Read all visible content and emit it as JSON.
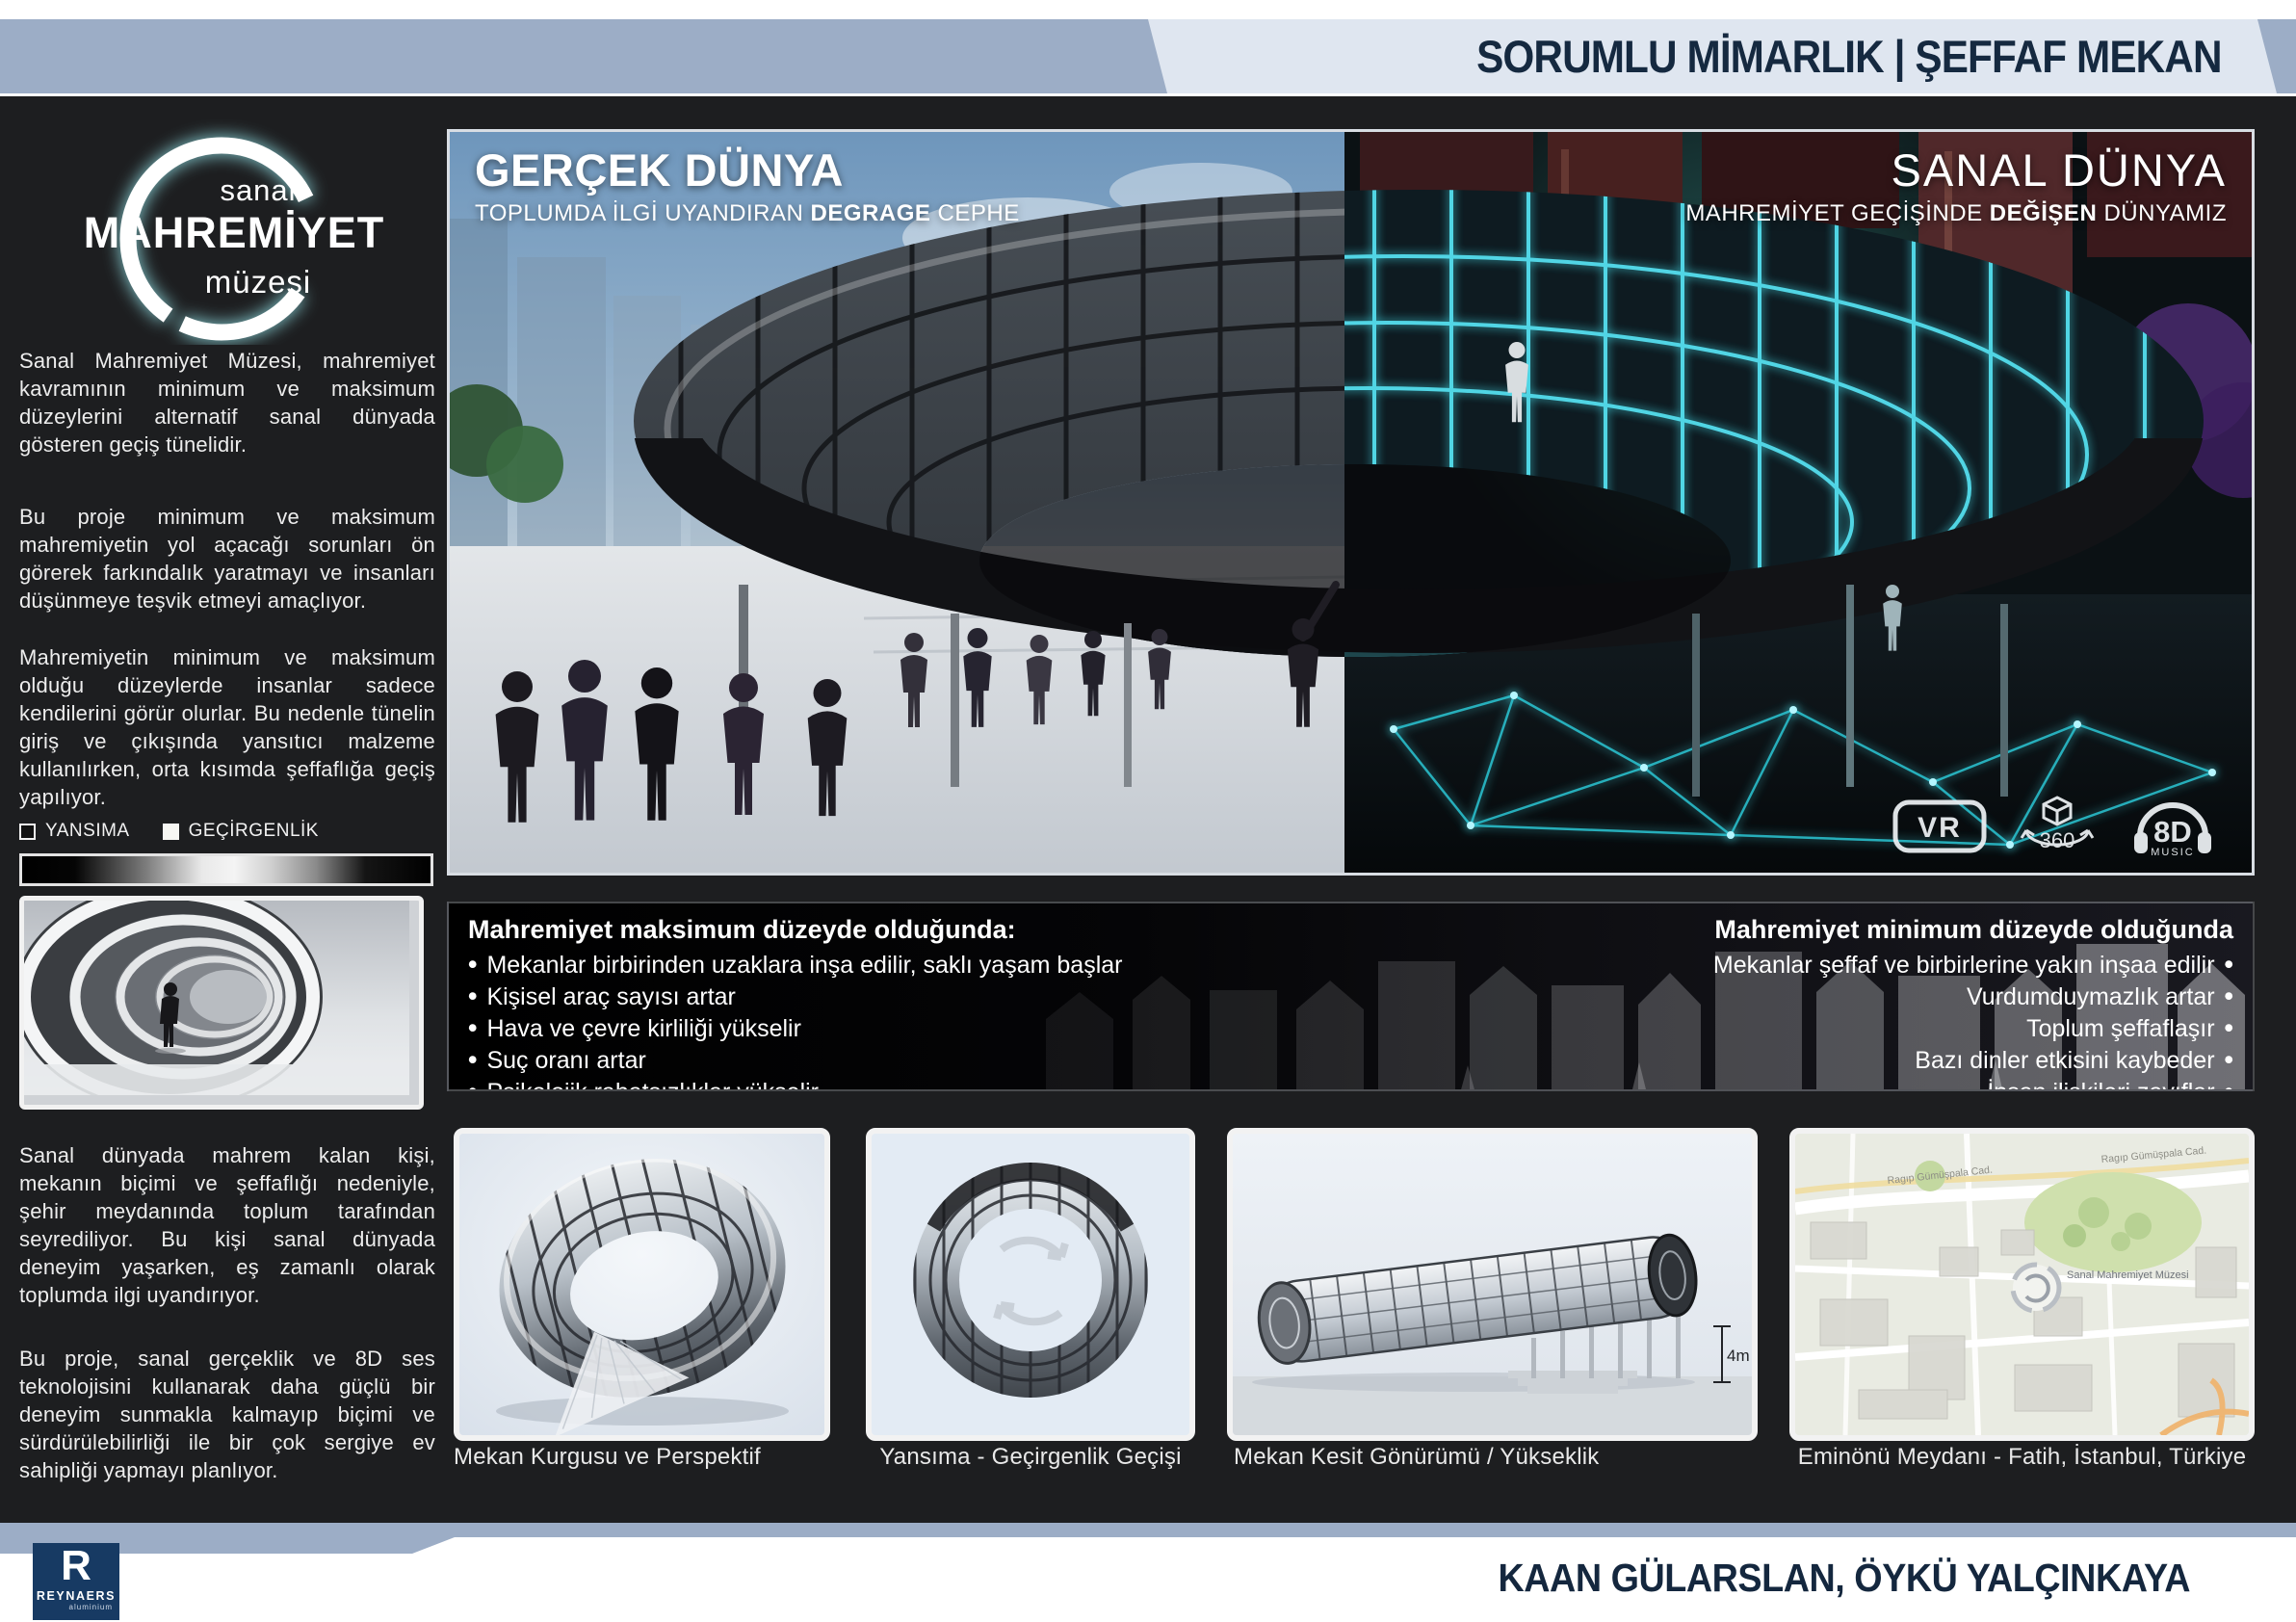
{
  "header": {
    "title": "SORUMLU MİMARLIK | ŞEFFAF MEKAN"
  },
  "logo": {
    "line1": "sanal",
    "line2": "MAHREMİYET",
    "line3": "müzesi"
  },
  "sidebar": {
    "paragraphs": [
      "Sanal Mahremiyet Müzesi, mahremiyet kavramının minimum ve maksimum düzeylerini alternatif sanal dünyada gösteren geçiş tünelidir.",
      "Bu proje minimum ve maksimum mahremiyetin yol açacağı sorunları ön görerek farkındalık yaratmayı ve insanları düşünmeye teşvik etmeyi amaçlıyor.",
      "Mahremiyetin minimum ve maksimum olduğu düzeylerde insanlar sadece kendilerini görür olurlar. Bu nedenle tünelin giriş ve çıkışında yansıtıcı malzeme kullanılırken, orta kısımda şeffaflığa geçiş yapılıyor.",
      "Sanal dünyada mahrem kalan kişi, mekanın biçimi ve şeffaflığı nedeniyle, şehir meydanında toplum tarafından seyrediliyor. Bu kişi sanal dünyada deneyim yaşarken, eş zamanlı olarak toplumda ilgi uyandırıyor.",
      "Bu proje, sanal gerçeklik ve 8D ses teknolojisini kullanarak daha güçlü bir deneyim sunmakla kalmayıp biçimi ve sürdürülebilirliği ile bir çok sergiye ev sahipliği yapmayı planlıyor."
    ],
    "legend": {
      "item1": "YANSIMA",
      "item2": "GEÇİRGENLİK"
    }
  },
  "hero": {
    "left": {
      "title": "GERÇEK DÜNYA",
      "sub_pre": "TOPLUMDA İLGİ UYANDIRAN ",
      "sub_bold": "DEGRAGE",
      "sub_post": " CEPHE"
    },
    "right": {
      "title": "SANAL DÜNYA",
      "sub_pre": "MAHREMİYET GEÇİŞİNDE ",
      "sub_bold": "DEĞİŞEN",
      "sub_post": " DÜNYAMIZ"
    },
    "badges": {
      "vr": "VR",
      "deg360": "360",
      "eightd": "8D",
      "eightd_sub": "MUSIC"
    }
  },
  "conditions": {
    "max": {
      "title": "Mahremiyet maksimum düzeyde olduğunda:",
      "items": [
        "Mekanlar birbirinden uzaklara inşa edilir, saklı yaşam başlar",
        "Kişisel araç sayısı artar",
        "Hava ve çevre kirliliği yükselir",
        "Suç oranı artar",
        "Psikolojik rahatsızlıklar yükselir"
      ]
    },
    "min": {
      "title": "Mahremiyet minimum düzeyde olduğunda",
      "items": [
        "Mekanlar şeffaf ve birbirlerine yakın inşaa edilir",
        "Vurdumduymazlık artar",
        "Toplum şeffaflaşır",
        "Bazı dinler etkisini kaybeder",
        "İnsan ilişkileri zayıflar"
      ]
    }
  },
  "gallery": [
    {
      "caption": "Mekan Kurgusu ve Perspektif"
    },
    {
      "caption": "Yansıma - Geçirgenlik Geçişi"
    },
    {
      "caption": "Mekan Kesit Gönürümü / Yükseklik",
      "annotation": "4m"
    },
    {
      "caption": "Eminönü Meydanı - Fatih, İstanbul, Türkiye",
      "map_labels": [
        "Ragıp Gümüşpala Cad.",
        "Ragıp Gümüşpala Cad.",
        "Sanal Mahremiyet Müzesi"
      ]
    }
  ],
  "footer": {
    "credits": "KAAN GÜLARSLAN, ÖYKÜ YALÇINKAYA",
    "logo": {
      "initial": "R",
      "name": "REYNAERS",
      "sub": "aluminium"
    }
  },
  "colors": {
    "band_blue": "#9cadc6",
    "panel_light": "#dfe6f0",
    "navy": "#152940",
    "poster_bg": "#1d1e20",
    "accent_cyan": "#45e2f0",
    "reynaers_navy": "#173a63"
  }
}
